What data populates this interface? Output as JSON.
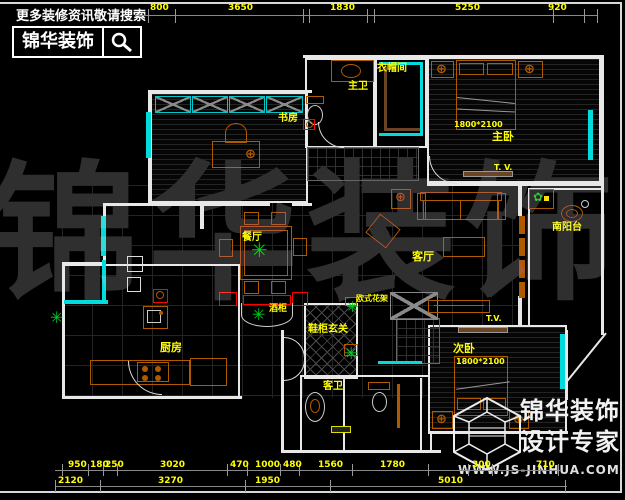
{
  "header": {
    "hint": "更多装修资讯敬请搜索",
    "brand": "锦华装饰"
  },
  "watermark": {
    "text": "锦华装饰"
  },
  "footer_logo": {
    "brand": "锦华装饰",
    "tagline": "设计专家",
    "website": "WWW.JS-JINHUA.COM"
  },
  "dims": {
    "top": [
      "800",
      "3650",
      "1830",
      "5250",
      "920"
    ],
    "bottom_row1": [
      "950",
      "180",
      "250",
      "3020",
      "470",
      "1000",
      "480",
      "1560",
      "1780",
      "300",
      "710"
    ],
    "bottom_row2": [
      "2120",
      "3270",
      "1950",
      "5010"
    ]
  },
  "rooms": {
    "study": "书房",
    "master_bath": "主卫",
    "closet": "衣帽间",
    "master_bedroom": "主卧",
    "dining": "餐厅",
    "living": "客厅",
    "south_balcony": "南阳台",
    "kitchen": "厨房",
    "entry": "鞋柜玄关",
    "guest_bath": "客卫",
    "second_bedroom": "次卧"
  },
  "annotations": {
    "wine_cabinet": "酒柜",
    "flower_stand": "欧式花架",
    "tv_master": "T. V.",
    "tv_living": "T.V.",
    "bed_size_master": "1800*2100",
    "bed_size_second": "1800*2100"
  },
  "icons": {
    "search": "magnifier",
    "logo_mark": "hex-cube",
    "plant_glyph": "✳",
    "lamp_glyph": "⊕",
    "flower_glyph": "✿"
  },
  "colors": {
    "background": "#000000",
    "wall": "#e8e8e8",
    "window_cyan": "#00dcdc",
    "furniture_orange": "#b05a00",
    "label_yellow": "#ffff00",
    "plant_green": "#00cc22",
    "alert_red": "#ff0000",
    "wood_brown": "#6b4423"
  }
}
